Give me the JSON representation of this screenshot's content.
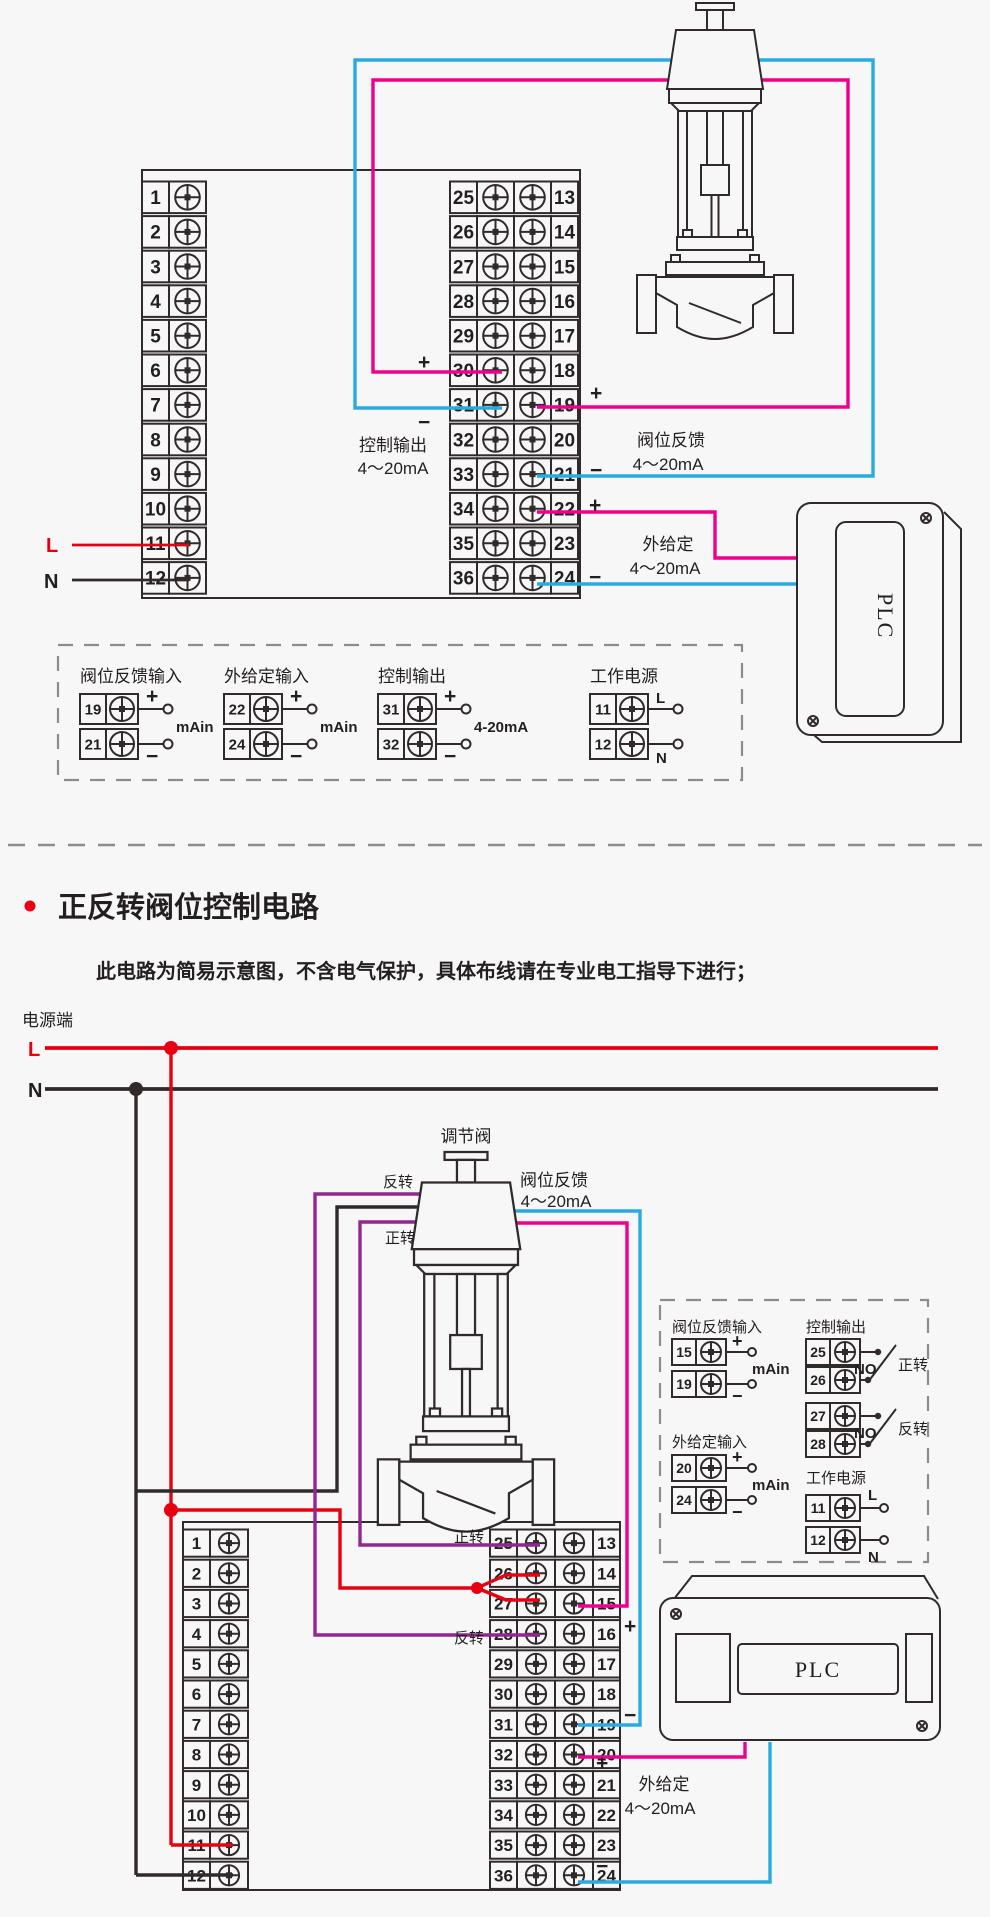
{
  "colors": {
    "red": "#e60012",
    "pink": "#ec008c",
    "blue": "#29abe2",
    "purple": "#92278f",
    "line": "#302a2b",
    "dash": "#8c8c8c",
    "background": "#f7f7f7"
  },
  "signs": {
    "plus": "+",
    "minus": "−"
  },
  "section": {
    "title": "正反转阀位控制电路",
    "note": "此电路为简易示意图，不含电气保护，具体布线请在专业电工指导下进行；"
  },
  "diagram1": {
    "terminals": {
      "left": [
        "1",
        "2",
        "3",
        "4",
        "5",
        "6",
        "7",
        "8",
        "9",
        "10",
        "11",
        "12"
      ],
      "mid_left": [
        "25",
        "26",
        "27",
        "28",
        "29",
        "30",
        "31",
        "32",
        "33",
        "34",
        "35",
        "36"
      ],
      "mid_right": [
        "13",
        "14",
        "15",
        "16",
        "17",
        "18",
        "19",
        "20",
        "21",
        "22",
        "23",
        "24"
      ]
    },
    "labels": {
      "l": "L",
      "n": "N",
      "control_output": "控制输出",
      "control_output_range": "4～20mA",
      "valve_feedback": "阀位反馈",
      "valve_feedback_range": "4～20mA",
      "external_setpoint": "外给定",
      "external_setpoint_range": "4～20mA",
      "plc": "PLC"
    },
    "legend": {
      "groups": [
        {
          "title": "阀位反馈输入",
          "rows": [
            {
              "no": "19",
              "sign": "+"
            },
            {
              "no": "21",
              "sign": "−"
            }
          ],
          "note": "mAin"
        },
        {
          "title": "外给定输入",
          "rows": [
            {
              "no": "22",
              "sign": "+"
            },
            {
              "no": "24",
              "sign": "−"
            }
          ],
          "note": "mAin"
        },
        {
          "title": "控制输出",
          "rows": [
            {
              "no": "31",
              "sign": "+"
            },
            {
              "no": "32",
              "sign": "−"
            }
          ],
          "note": "4-20mA"
        },
        {
          "title": "工作电源",
          "rows": [
            {
              "no": "11",
              "sign": "L"
            },
            {
              "no": "12",
              "sign": "N"
            }
          ],
          "note": ""
        }
      ]
    }
  },
  "diagram2": {
    "terminals": {
      "left": [
        "1",
        "2",
        "3",
        "4",
        "5",
        "6",
        "7",
        "8",
        "9",
        "10",
        "11",
        "12"
      ],
      "mid_left": [
        "25",
        "26",
        "27",
        "28",
        "29",
        "30",
        "31",
        "32",
        "33",
        "34",
        "35",
        "36"
      ],
      "mid_right": [
        "13",
        "14",
        "15",
        "16",
        "17",
        "18",
        "19",
        "20",
        "21",
        "22",
        "23",
        "24"
      ]
    },
    "labels": {
      "power": "电源端",
      "l": "L",
      "n": "N",
      "valve": "调节阀",
      "reverse": "反转",
      "forward": "正转",
      "forward_term": "正转",
      "reverse_term": "反转",
      "valve_feedback": "阀位反馈",
      "valve_feedback_range": "4～20mA",
      "external_setpoint": "外给定",
      "external_setpoint_range": "4～20mA",
      "plc": "PLC"
    },
    "legend": {
      "left_groups": [
        {
          "title": "阀位反馈输入",
          "rows": [
            {
              "no": "15",
              "sign": "+"
            },
            {
              "no": "19",
              "sign": "−"
            }
          ],
          "note": "mAin"
        },
        {
          "title": "外给定输入",
          "rows": [
            {
              "no": "20",
              "sign": "+"
            },
            {
              "no": "24",
              "sign": "−"
            }
          ],
          "note": "mAin"
        }
      ],
      "switch_group": {
        "title": "控制输出",
        "pairs": [
          {
            "top": "25",
            "bottom": "26",
            "contact": "NO",
            "dir": "正转"
          },
          {
            "top": "27",
            "bottom": "28",
            "contact": "NO",
            "dir": "反转"
          }
        ]
      },
      "power_group": {
        "title": "工作电源",
        "rows": [
          {
            "no": "11",
            "sign": "L"
          },
          {
            "no": "12",
            "sign": "N"
          }
        ]
      }
    }
  }
}
